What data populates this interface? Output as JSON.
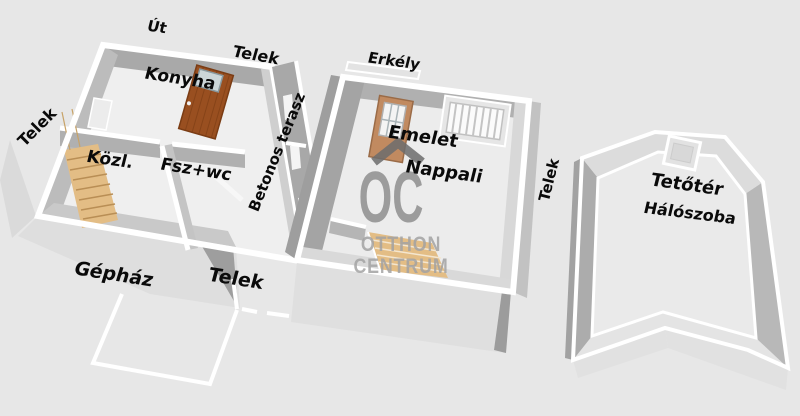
{
  "labels": {
    "ut": "Út",
    "telek_top": "Telek",
    "konyha": "Konyha",
    "telek_left": "Telek",
    "kozl": "Közl.",
    "fsz_wc": "Fsz+wc",
    "betonos_terasz": "Betonos terasz",
    "gephaz": "Gépház",
    "telek_bottom": "Telek",
    "erkely": "Erkély",
    "emelet": "Emelet",
    "nappali": "Nappali",
    "telek_middle": "Telek",
    "tetoter": "Tetőtér",
    "haloszoba": "Hálószoba"
  },
  "watermark": {
    "initials": "OC",
    "line1": "OTTHON",
    "line2": "CENTRUM"
  },
  "colors": {
    "background": "#e7e7e7",
    "wall_white": "#ffffff",
    "wall_shade": "#a8a8a8",
    "floor_light": "#efefef",
    "skirt_gray": "#dedede",
    "stairs_tan": "#e3bd85",
    "counter_brown": "#994f20",
    "sink_gray": "#ccd6d8",
    "door_tan": "#c18a60",
    "glass_white": "#f4f4f4",
    "watermark_gray": "#8f8f8f",
    "watermark_light": "#a3a3a3",
    "logo_roof_gray": "#6d6d6d",
    "label_black": "#0a0a0a"
  }
}
